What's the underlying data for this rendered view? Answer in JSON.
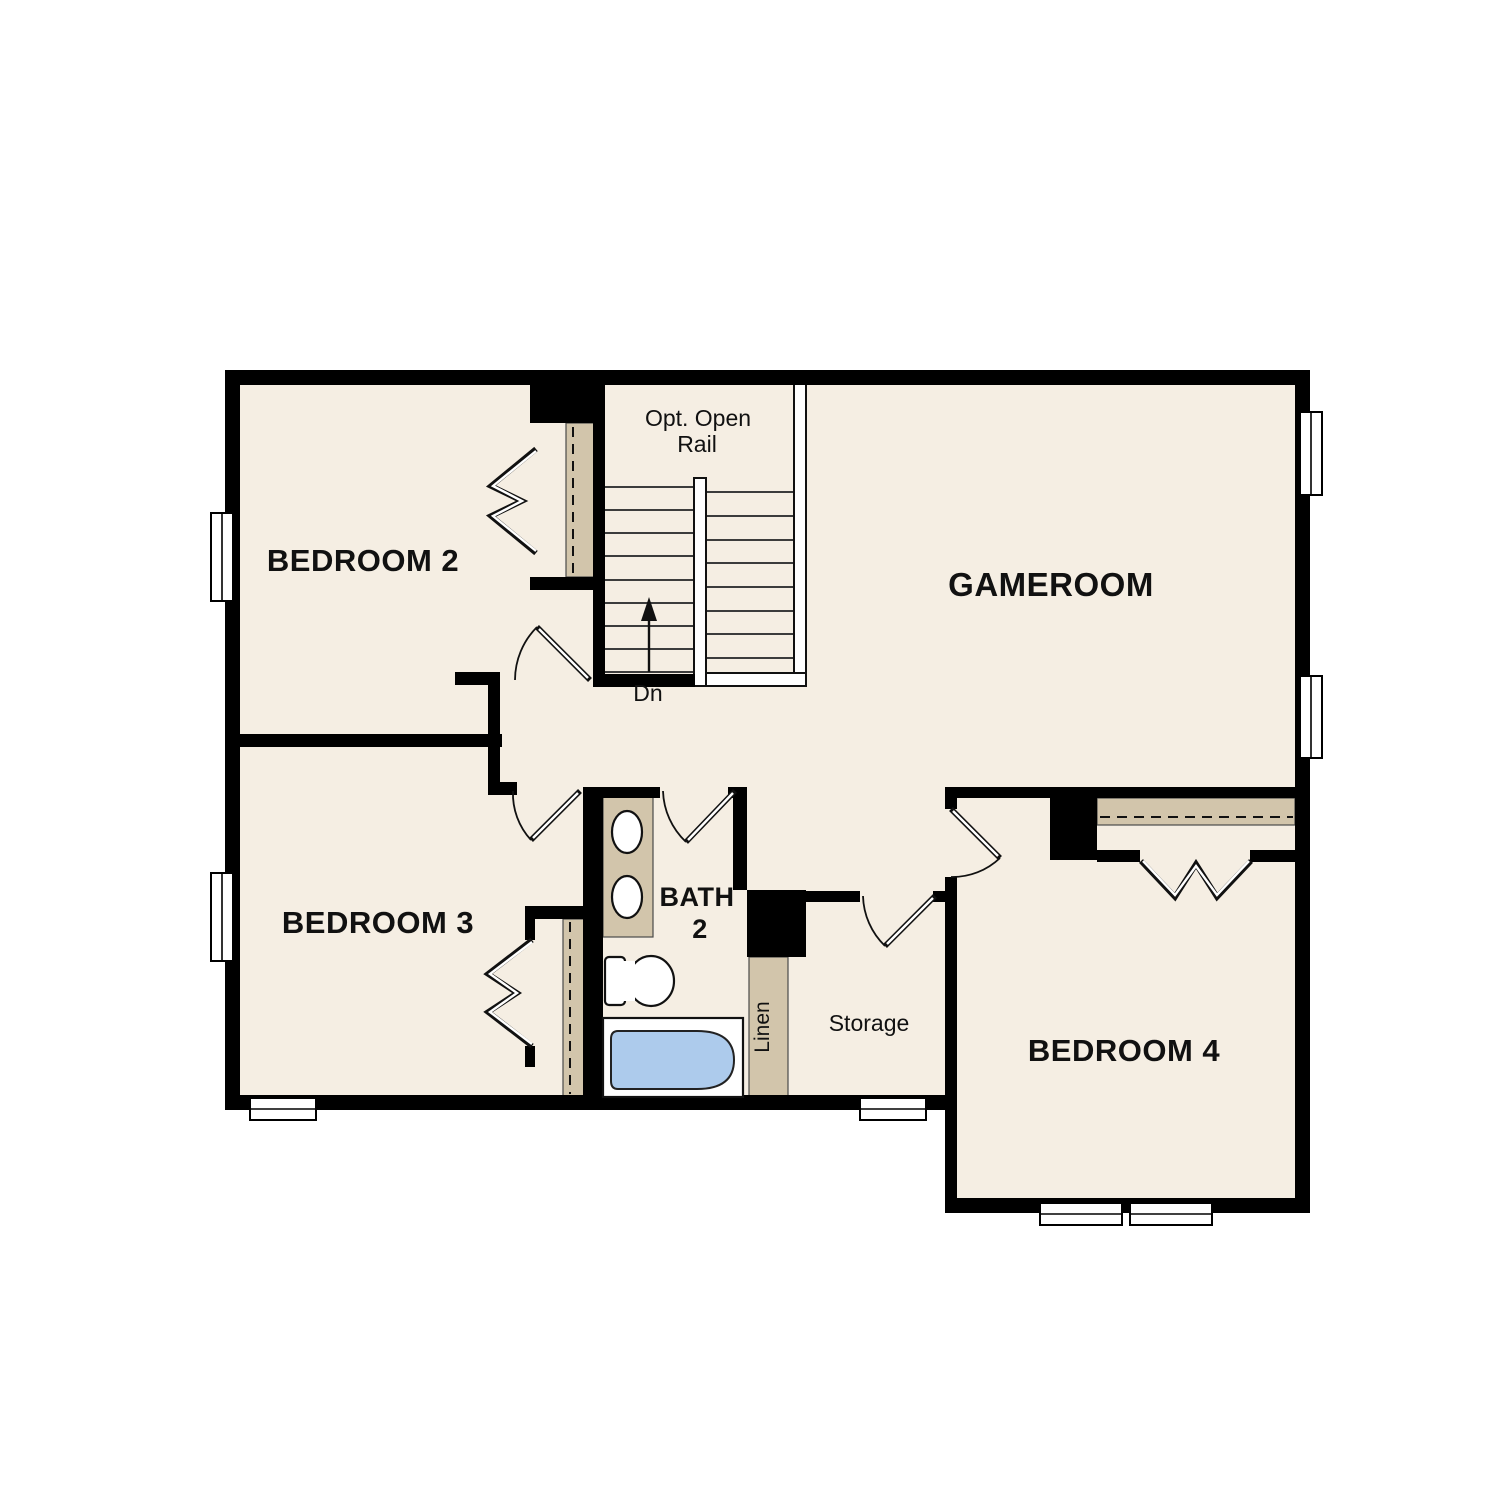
{
  "labels": {
    "bedroom2": "BEDROOM 2",
    "bedroom3": "BEDROOM 3",
    "bedroom4": "BEDROOM 4",
    "gameroom": "GAMEROOM",
    "bath2_line1": "BATH",
    "bath2_line2": "2",
    "storage": "Storage",
    "linen": "Linen",
    "stair_note_line1": "Opt. Open",
    "stair_note_line2": "Rail",
    "stair_direction": "Dn"
  },
  "colors": {
    "background": "#ffffff",
    "floor_fill": "#f5eee3",
    "wall": "#000000",
    "casework": "#d2c5ab",
    "plumbing_blue": "#adcbec",
    "label_text": "#111111"
  }
}
